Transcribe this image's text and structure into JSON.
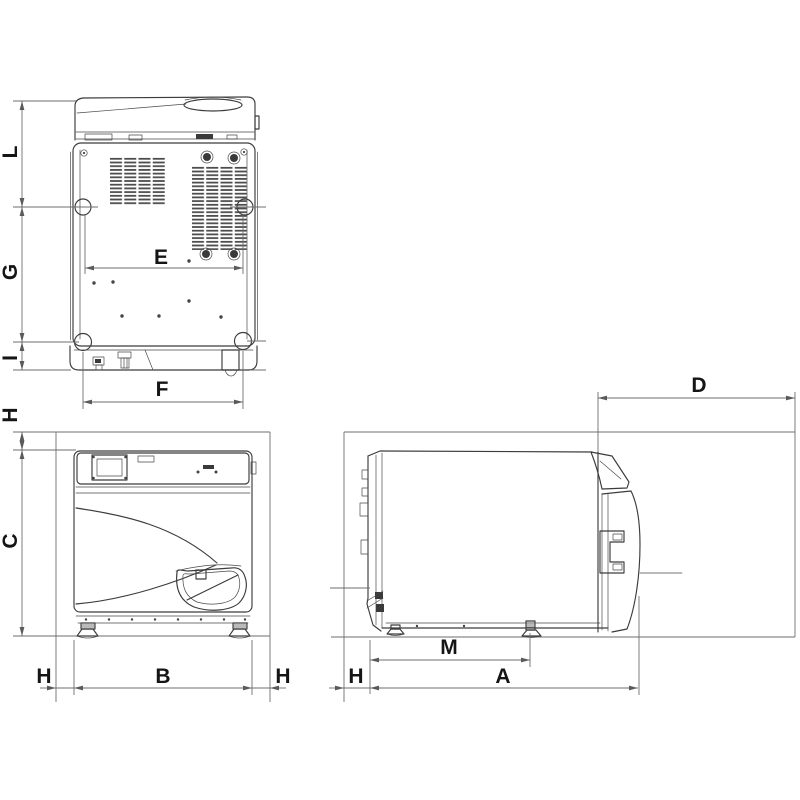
{
  "colors": {
    "background": "#ffffff",
    "machine_line": "#3c3c3c",
    "dimension_line": "#6e6e6e",
    "label": "#151515"
  },
  "views": {
    "back": {
      "dims": {
        "L": "L",
        "G": "G",
        "I": "I",
        "E": "E",
        "F": "F"
      }
    },
    "front": {
      "dims": {
        "H_top": "H",
        "C": "C",
        "H_left": "H",
        "B": "B",
        "H_right": "H"
      }
    },
    "side": {
      "dims": {
        "D": "D",
        "M": "M",
        "A": "A",
        "H_back": "H"
      }
    }
  }
}
